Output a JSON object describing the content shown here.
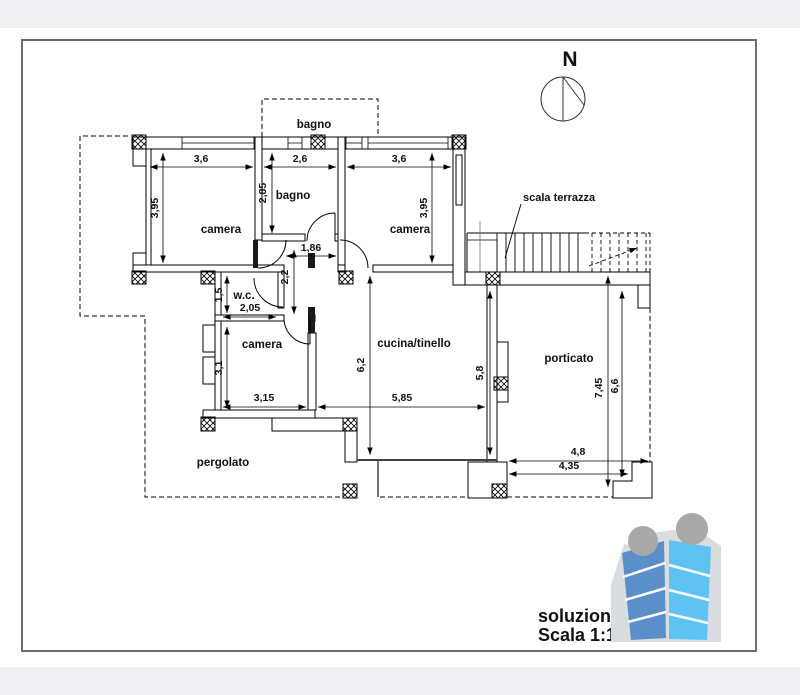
{
  "sheet": {
    "type_note": "architectural plan sheet"
  },
  "compass": {
    "north_label": "N"
  },
  "rooms": {
    "bagno_top": "bagno",
    "bagno": "bagno",
    "camera_nw": "camera",
    "camera_ne": "camera",
    "wc": "w.c.",
    "camera_sw": "camera",
    "cucina": "cucina/tinello",
    "porticato": "porticato",
    "pergolato": "pergolato"
  },
  "annotations": {
    "stairs_label": "scala terrazza"
  },
  "dimensions": {
    "camera_nw_w": "3,6",
    "bagno_w": "2,6",
    "camera_ne_w": "3,6",
    "camera_nw_h": "3,95",
    "bagno_h": "2,85",
    "camera_ne_h": "3,95",
    "hall_w": "1,86",
    "hall_h": "2,2",
    "wc_h": "1,5",
    "wc_w": "2,05",
    "camera_sw_h": "3,1",
    "camera_sw_w": "3,15",
    "cucina_w": "5,85",
    "cucina_h": "6,2",
    "porticato_h": "5,8",
    "porticato_right_outer": "7,45",
    "porticato_right_inner": "6,6",
    "porticato_bottom_outer": "4,8",
    "porticato_bottom_inner": "4,35"
  },
  "title_block": {
    "line1": "soluzione 3",
    "line2": "Scala 1:100"
  },
  "colors": {
    "logo_left_body": "#5b8fc9",
    "logo_right_body": "#5ec3f2",
    "logo_head": "#a8a8a8",
    "logo_bg": "#d9dde0",
    "strip": "#edeff2",
    "sheet_border": "#6e6e6e"
  }
}
